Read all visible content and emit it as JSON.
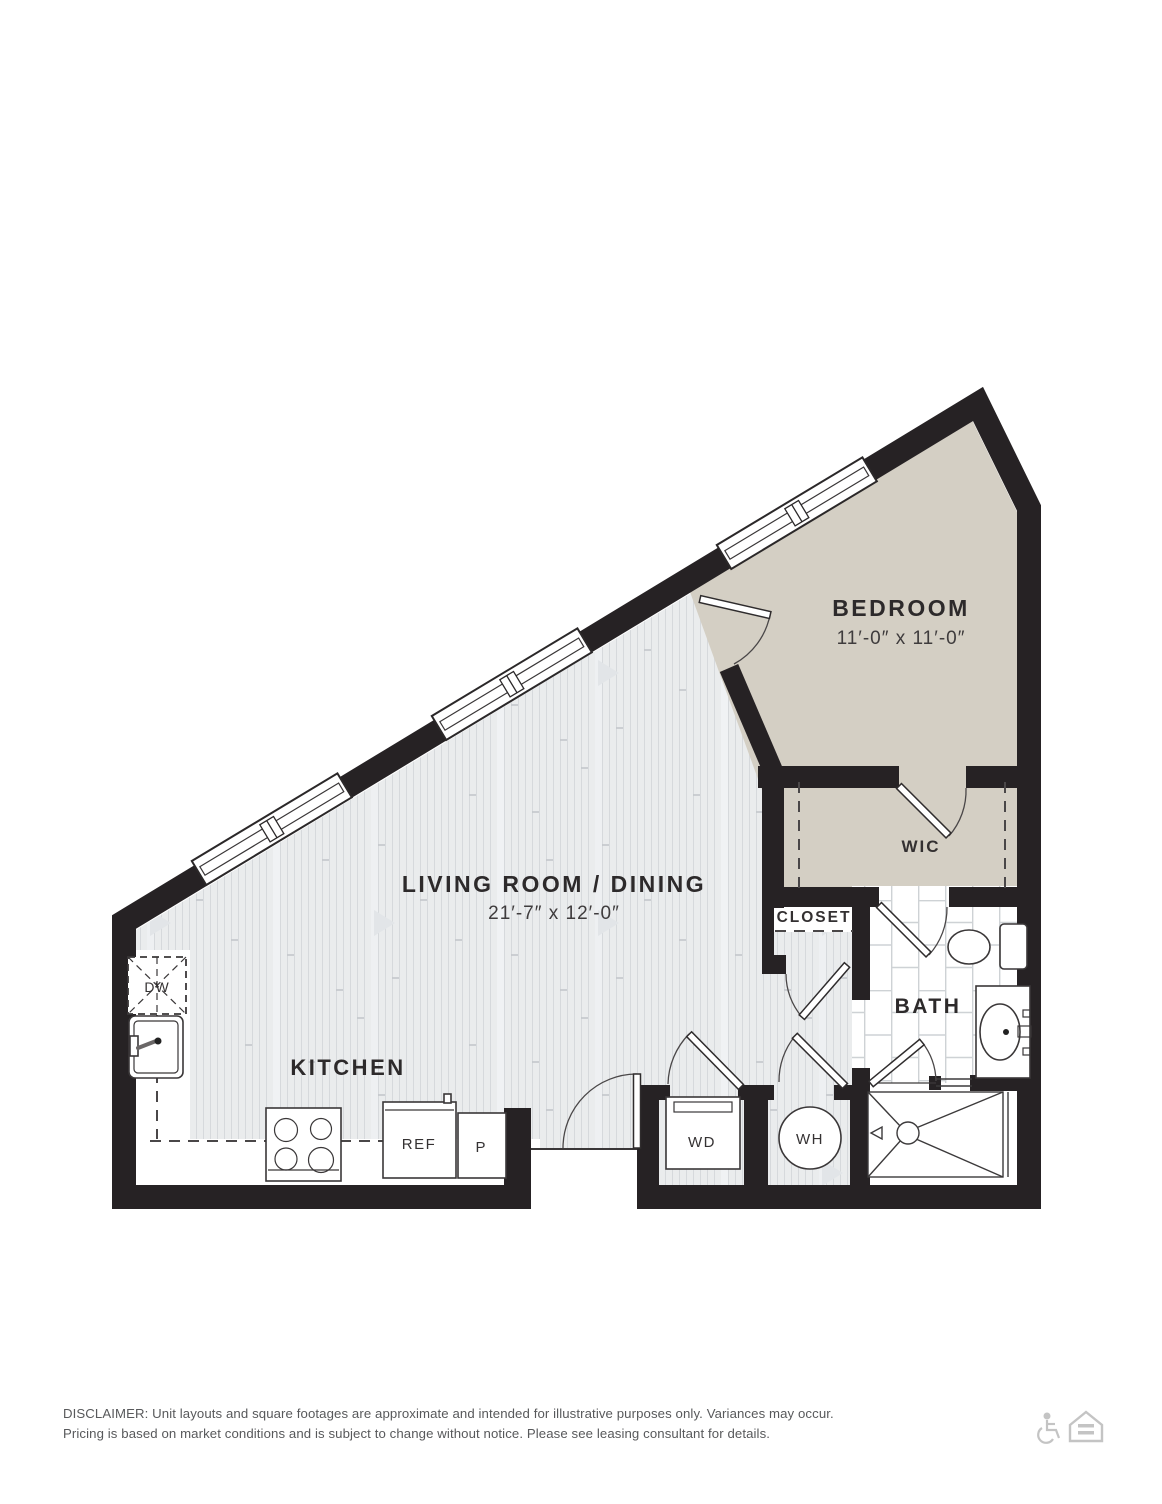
{
  "colors": {
    "wall": "#262224",
    "bedroom_fill": "#d4cfc4",
    "wood_base": "#eaeced",
    "wood_line": "#d6d9dc",
    "tile_line": "#ced2d5",
    "label": "#2d2a2b",
    "disclaimer_text": "#58595b",
    "icon_gray": "#c4c4c4"
  },
  "rooms": {
    "bedroom": {
      "name": "BEDROOM",
      "dims": "11′-0″ x 11′-0″"
    },
    "living": {
      "name": "LIVING ROOM / DINING",
      "dims": "21′-7″ x 12′-0″"
    },
    "kitchen": {
      "name": "KITCHEN"
    },
    "wic": {
      "name": "WIC"
    },
    "closet": {
      "name": "CLOSET"
    },
    "bath": {
      "name": "BATH"
    }
  },
  "fixtures": {
    "dishwasher": "DW",
    "refrigerator": "REF",
    "pantry": "P",
    "washer_dryer": "WD",
    "water_heater": "WH"
  },
  "disclaimer": {
    "line1": "DISCLAIMER: Unit layouts and square footages are approximate and intended for illustrative purposes only. Variances may occur.",
    "line2": "Pricing is based on market conditions and is subject to change without notice. Please see leasing consultant for details."
  },
  "icons": {
    "accessibility": "accessibility-icon",
    "equal_housing": "equal-housing-icon"
  }
}
